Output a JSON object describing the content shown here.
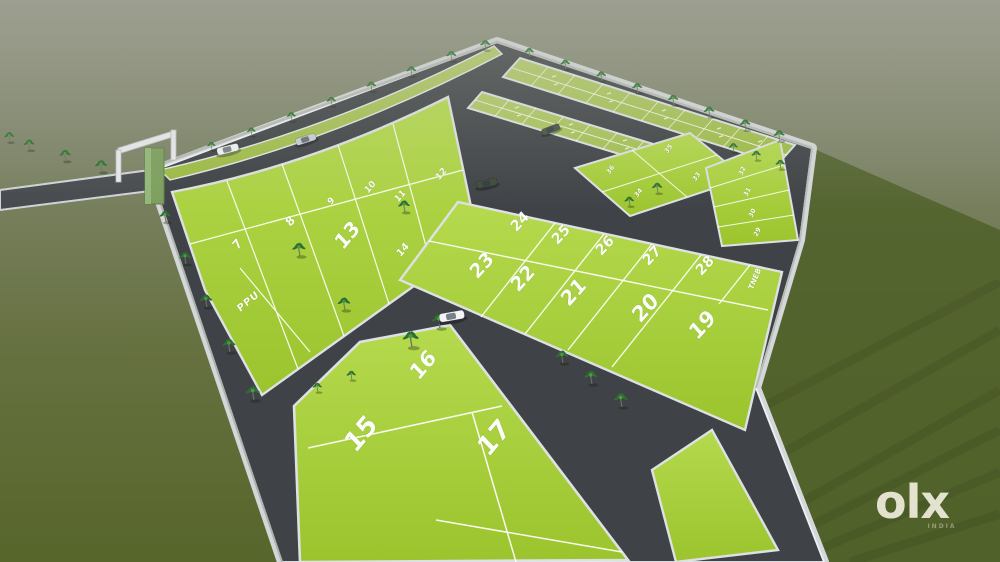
{
  "watermark": {
    "brand": "olx",
    "country": "INDIA"
  },
  "palette": {
    "grass": "#a6ce39",
    "grass_far": "#9fc04c",
    "road": "#3f4347",
    "curb": "#d7dbde",
    "ground_top": "#8a8d7d",
    "ground_bottom": "#57662b",
    "ground_right": "#4d5e29",
    "wall": "#b7bcb6",
    "tree_leaf": "#2f6e33",
    "tree_trunk": "#6f7262",
    "car_white": "#f2f4f6",
    "car_silver": "#c9ced3",
    "car_dark": "#3e4a3c",
    "plot_number_color": "#ffffff"
  },
  "plot_labels": {
    "p7": "7",
    "p8": "8",
    "p9": "9",
    "p10": "10",
    "p11": "11",
    "p12": "12",
    "p13": "13",
    "p14": "14",
    "ppu": "PPU",
    "p15": "15",
    "p16": "16",
    "p17": "17",
    "p19": "19",
    "p20": "20",
    "p21": "21",
    "p22": "22",
    "p23": "23",
    "p24": "24",
    "p25": "25",
    "p26": "26",
    "p27": "27",
    "p28": "28",
    "tneb": "TNEB",
    "p29": "29",
    "p30": "30",
    "p31": "31",
    "p32": "32",
    "p33": "33",
    "p34": "34",
    "p35": "35",
    "p36": "36"
  }
}
